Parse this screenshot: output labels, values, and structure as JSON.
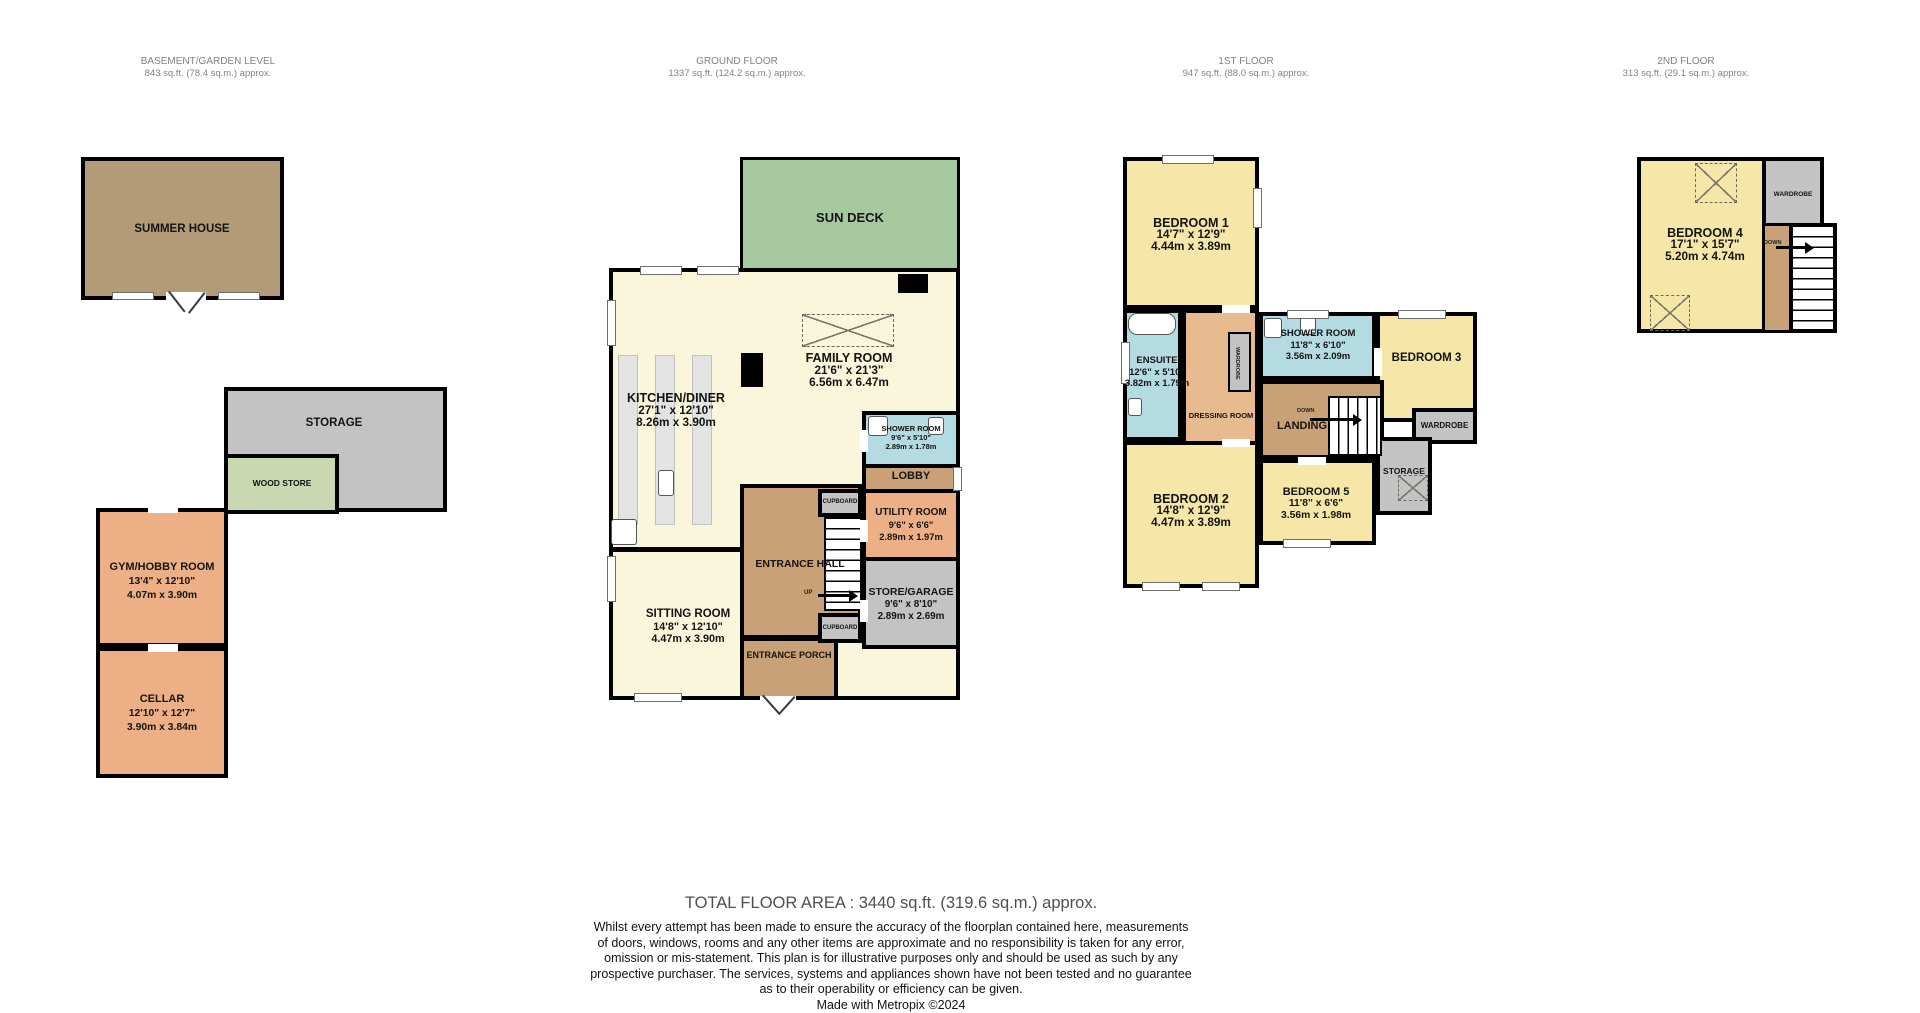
{
  "document_type": "property floorplan",
  "colors": {
    "wall": "#000000",
    "bedroom_yellow": "#f6e7a9",
    "living_cream": "#faf6dc",
    "bathroom_blue": "#b5dbe2",
    "utility_orange": "#edb086",
    "hall_tan": "#c8a176",
    "dressing_peach": "#e8ba90",
    "storage_gray": "#c3c3c3",
    "summerhouse_brown": "#b49b77",
    "deck_green": "#a5c89e",
    "woodstore_green": "#c9d8b1"
  },
  "floors": {
    "basement": {
      "title": "BASEMENT/GARDEN LEVEL",
      "area": "843 sq.ft. (78.4 sq.m.) approx."
    },
    "ground": {
      "title": "GROUND FLOOR",
      "area": "1337 sq.ft. (124.2 sq.m.) approx."
    },
    "first": {
      "title": "1ST FLOOR",
      "area": "947 sq.ft. (88.0 sq.m.) approx."
    },
    "second": {
      "title": "2ND FLOOR",
      "area": "313 sq.ft. (29.1 sq.m.) approx."
    }
  },
  "rooms": {
    "summer_house": {
      "name": "SUMMER HOUSE"
    },
    "storage_basement": {
      "name": "STORAGE"
    },
    "wood_store": {
      "name": "WOOD STORE"
    },
    "gym": {
      "name": "GYM/HOBBY ROOM",
      "ft": "13'4\" x 12'10\"",
      "m": "4.07m x 3.90m"
    },
    "cellar": {
      "name": "CELLAR",
      "ft": "12'10\" x 12'7\"",
      "m": "3.90m x 3.84m"
    },
    "sun_deck": {
      "name": "SUN DECK"
    },
    "family": {
      "name": "FAMILY ROOM",
      "ft": "21'6\" x 21'3\"",
      "m": "6.56m x 6.47m"
    },
    "kitchen": {
      "name": "KITCHEN/DINER",
      "ft": "27'1\" x 12'10\"",
      "m": "8.26m x 3.90m"
    },
    "shower_ground": {
      "name": "SHOWER ROOM",
      "ft": "9'6\" x 5'10\"",
      "m": "2.89m x 1.78m"
    },
    "lobby": {
      "name": "LOBBY"
    },
    "utility": {
      "name": "UTILITY ROOM",
      "ft": "9'6\" x 6'6\"",
      "m": "2.89m x 1.97m"
    },
    "entrance_hall": {
      "name": "ENTRANCE HALL"
    },
    "cupboard_top": {
      "name": "CUPBOARD"
    },
    "cupboard_bottom": {
      "name": "CUPBOARD"
    },
    "store_garage": {
      "name": "STORE/GARAGE",
      "ft": "9'6\" x 8'10\"",
      "m": "2.89m x 2.69m"
    },
    "sitting": {
      "name": "SITTING ROOM",
      "ft": "14'8\" x 12'10\"",
      "m": "4.47m x 3.90m"
    },
    "porch": {
      "name": "ENTRANCE PORCH"
    },
    "bedroom1": {
      "name": "BEDROOM 1",
      "ft": "14'7\" x 12'9\"",
      "m": "4.44m x 3.89m"
    },
    "ensuite": {
      "name": "ENSUITE",
      "ft": "12'6\" x 5'10\"",
      "m": "3.82m x 1.79m"
    },
    "shower_first": {
      "name": "SHOWER ROOM",
      "ft": "11'8\" x 6'10\"",
      "m": "3.56m x 2.09m"
    },
    "bedroom3": {
      "name": "BEDROOM 3"
    },
    "dressing": {
      "name": "DRESSING ROOM"
    },
    "landing": {
      "name": "LANDING"
    },
    "wardrobe_mid": {
      "name": "WARDROBE"
    },
    "wardrobe_right": {
      "name": "WARDROBE"
    },
    "storage_first": {
      "name": "STORAGE"
    },
    "bedroom2": {
      "name": "BEDROOM 2",
      "ft": "14'8\" x 12'9\"",
      "m": "4.47m x 3.89m"
    },
    "bedroom5": {
      "name": "BEDROOM 5",
      "ft": "11'8\" x 6'6\"",
      "m": "3.56m x 1.98m"
    },
    "bedroom4": {
      "name": "BEDROOM 4",
      "ft": "17'1\" x 15'7\"",
      "m": "5.20m x 4.74m"
    },
    "wardrobe_second": {
      "name": "WARDROBE"
    }
  },
  "stairs": {
    "up": "UP",
    "down": "DOWN"
  },
  "footer": {
    "total": "TOTAL FLOOR AREA : 3440 sq.ft. (319.6 sq.m.) approx.",
    "lines": [
      "Whilst every attempt has been made to ensure the accuracy of the floorplan contained here, measurements",
      "of doors, windows, rooms and any other items are approximate and no responsibility is taken for any error,",
      "omission or mis-statement. This plan is for illustrative purposes only and should be used as such by any",
      "prospective purchaser. The services, systems and appliances shown have not been tested and no guarantee",
      "as to their operability or efficiency can be given."
    ],
    "credit": "Made with Metropix ©2024"
  }
}
